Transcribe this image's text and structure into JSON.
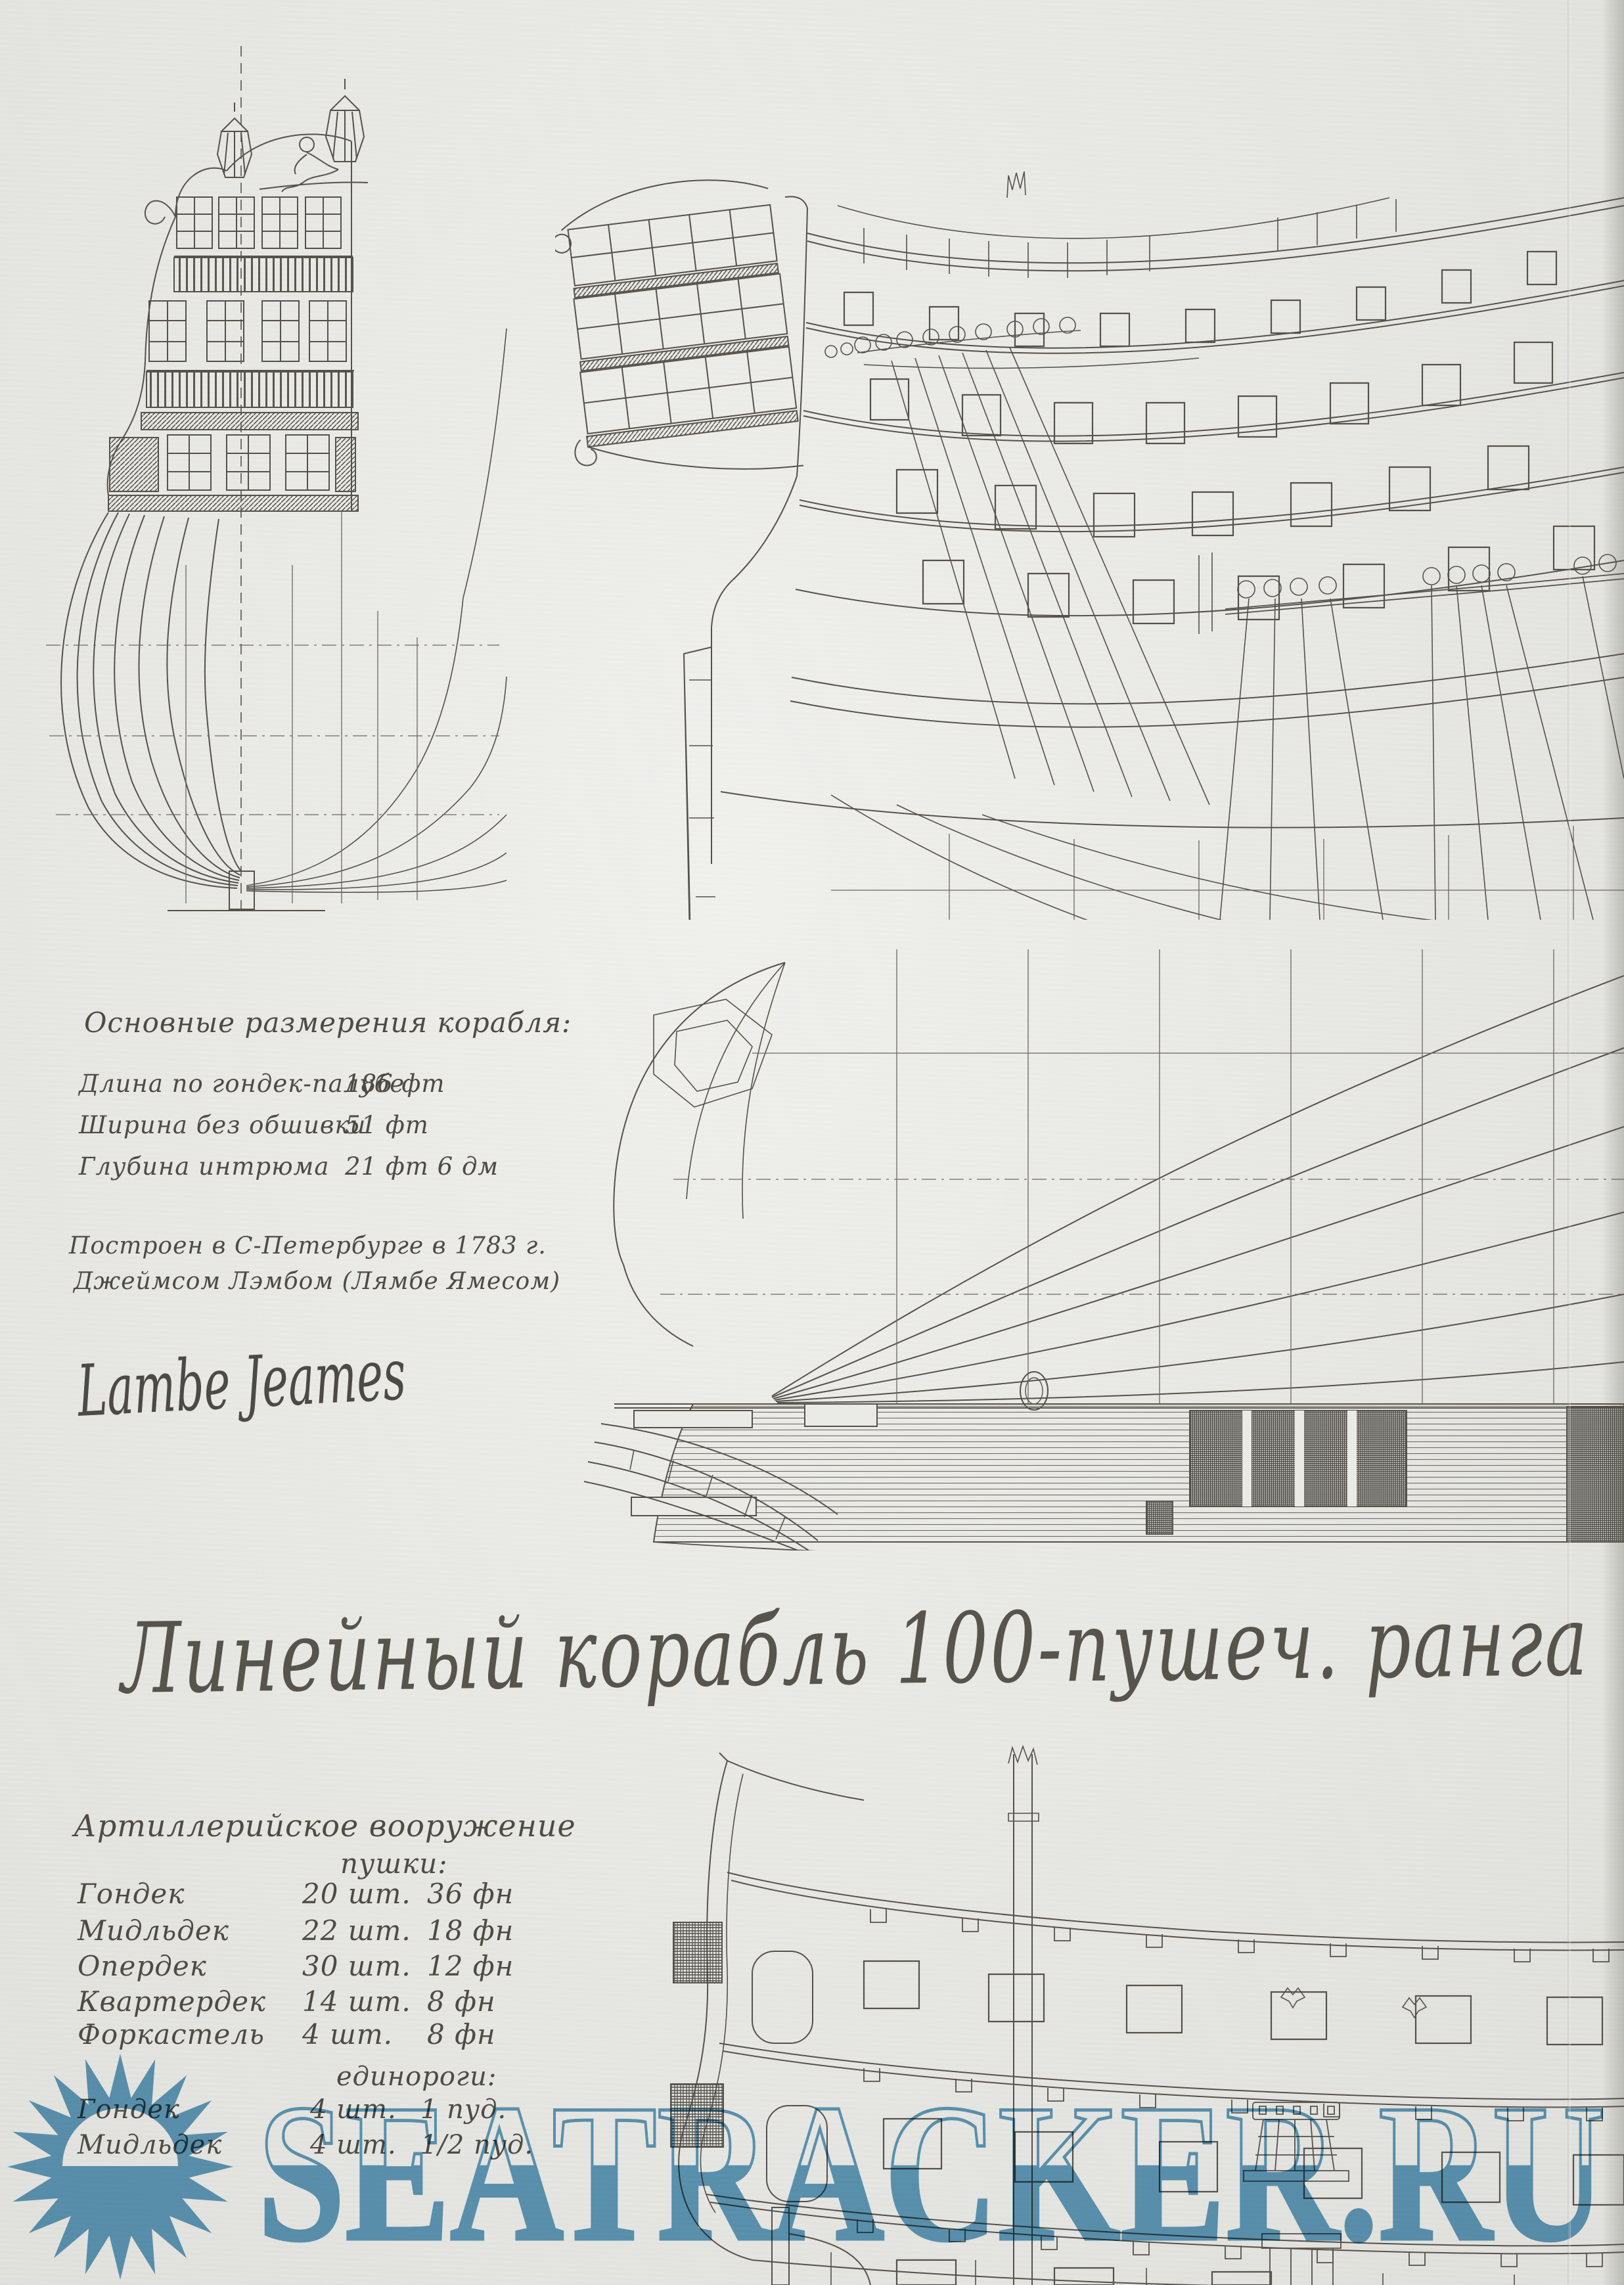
{
  "colors": {
    "paper": "#eaeae6",
    "ink": "#4d4b44",
    "watermark_blue": "#5598be"
  },
  "title": {
    "script_text": "Линейный корабль 100-пушеч. ранга"
  },
  "dimensions_block": {
    "heading": "Основные размерения корабля:",
    "rows": [
      {
        "label": "Длина по гондек-палубе",
        "value": "186 фт"
      },
      {
        "label": "Ширина без обшивки",
        "value": "51 фт"
      },
      {
        "label": "Глубина интрюма",
        "value": "21 фт 6 дм"
      }
    ]
  },
  "provenance": {
    "line1": "Построен в С-Петербурге в 1783 г.",
    "line2": "Джеймсом Лэмбом (Лямбе Ямесом)",
    "signature": "Lambe Jeames"
  },
  "armament_block": {
    "heading": "Артиллерийское вооружение",
    "guns_heading": "пушки:",
    "gun_rows": [
      {
        "deck": "Гондек",
        "qty": "20 шт.",
        "caliber": "36 фн"
      },
      {
        "deck": "Мидльдек",
        "qty": "22 шт.",
        "caliber": "18 фн"
      },
      {
        "deck": "Опердек",
        "qty": "30 шт.",
        "caliber": "12 фн"
      },
      {
        "deck": "Квартердек",
        "qty": "14 шт.",
        "caliber": "8 фн"
      },
      {
        "deck": "Форкастель",
        "qty": "4 шт.",
        "caliber": "8 фн"
      }
    ],
    "unicorns_heading": "единороги:",
    "unicorn_rows": [
      {
        "deck": "Гондек",
        "qty": "4 шт.",
        "caliber": "1 пуд."
      },
      {
        "deck": "Мидльдек",
        "qty": "4 шт.",
        "caliber": "1/2 пуд."
      }
    ]
  },
  "watermark": {
    "text": "SEATRACKER.RU"
  }
}
